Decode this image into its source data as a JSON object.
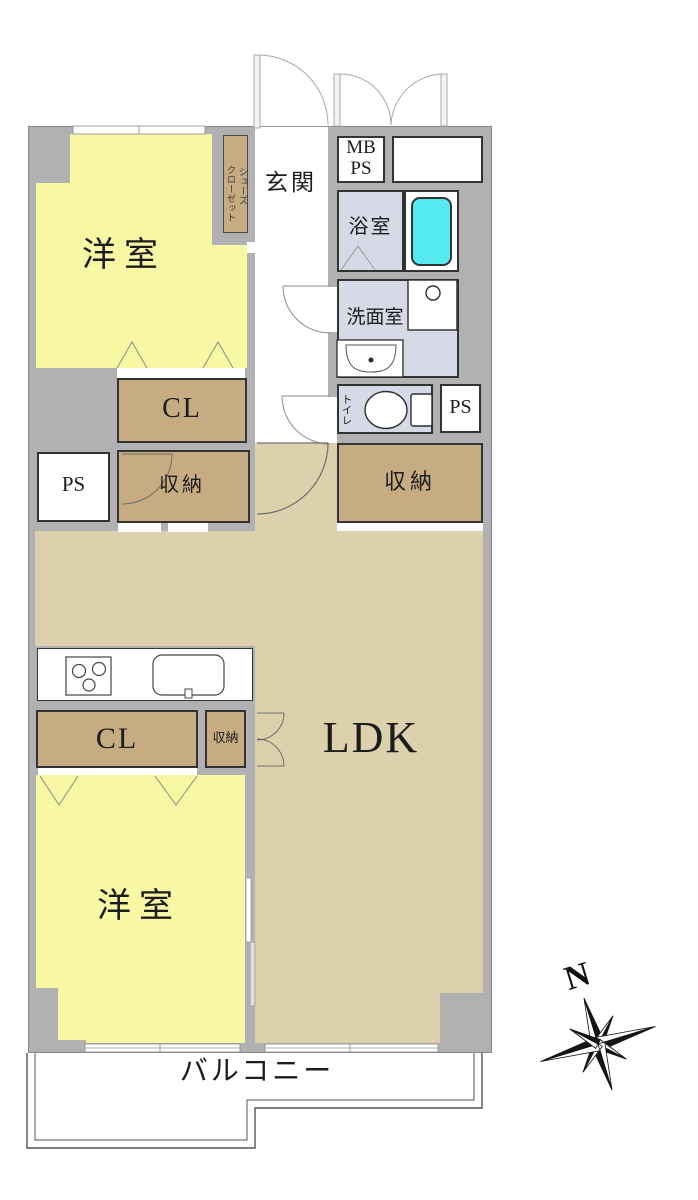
{
  "plan": {
    "type": "apartment-floor-plan",
    "labels": {
      "room1": "洋室",
      "room2": "洋室",
      "entrance": "玄関",
      "shoes_closet_line1": "シューズ",
      "shoes_closet_line2": "クローゼット",
      "mb": "MB",
      "ps_top": "PS",
      "bath": "浴室",
      "wash": "洗面室",
      "toilet": "トイレ",
      "ps_right": "PS",
      "storage_right": "収納",
      "cl_top": "CL",
      "ps_left": "PS",
      "storage_left": "収納",
      "ldk": "LDK",
      "cl_bottom": "CL",
      "storage_small": "収納",
      "balcony": "バルコニー",
      "north": "N"
    },
    "colors": {
      "wall": "#b1b1b3",
      "room_yellow": "#f8f7a3",
      "ldk_tan": "#ddd0ac",
      "closet_brown": "#c7ab82",
      "wet_lavender": "#d6d9e6",
      "bathtub_cyan": "#55eaf0",
      "outline": "#333333"
    }
  }
}
